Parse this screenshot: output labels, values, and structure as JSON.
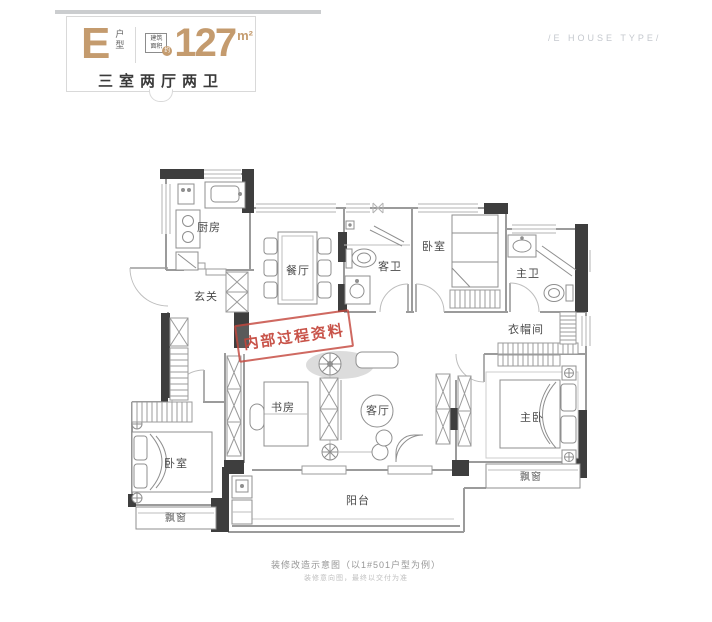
{
  "header": {
    "type_letter": "E",
    "type_suffix": "户型",
    "area_label_1": "建筑",
    "area_label_2": "面积",
    "area_approx": "约",
    "area_value": "127",
    "area_unit": "m²",
    "layout_desc": "三室两厅两卫",
    "subtitle_en": "/E HOUSE TYPE/"
  },
  "stamp": {
    "text": "内部过程资料"
  },
  "plan": {
    "rooms": {
      "kitchen": "厨房",
      "dining": "餐厅",
      "entry": "玄关",
      "guest_bath": "客卫",
      "bedroom_top": "卧室",
      "master_bath": "主卫",
      "cloakroom": "衣帽间",
      "study": "书房",
      "living": "客厅",
      "master_bedroom": "主卧",
      "bedroom_left": "卧室",
      "bay_window_left": "飘窗",
      "bay_window_right": "飘窗",
      "balcony": "阳台"
    }
  },
  "footer": {
    "caption": "装修改造示意图（以1#501户型为例）",
    "disclaimer": "装修意向图，最终以交付为准"
  },
  "colors": {
    "accent_gold": "#c49b6e",
    "stamp_red": "#c3443a",
    "wall_dark": "#3e3e3e",
    "wall_light": "#9b9b9b"
  }
}
